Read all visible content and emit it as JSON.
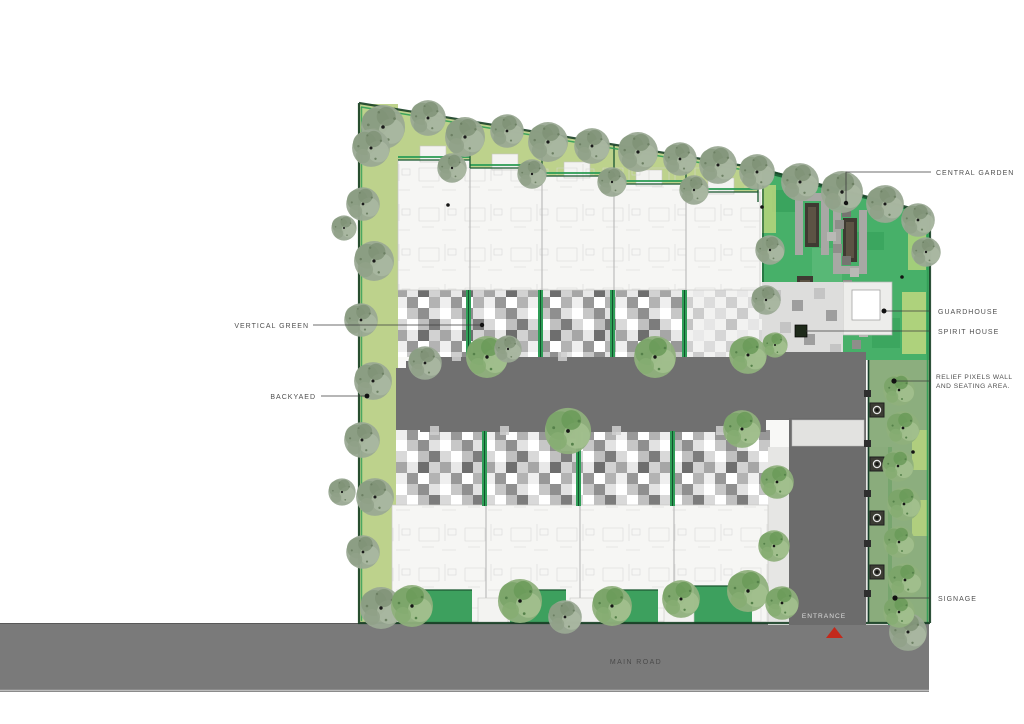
{
  "plan": {
    "annotations": {
      "central_garden": "CENTRAL GARDEN",
      "guardhouse": "GUARDHOUSE",
      "spirit_house": "SPIRIT HOUSE",
      "relief_wall_line1": "RELIEF PIXELS WALL",
      "relief_wall_line2": "AND SEATING AREA.",
      "signage": "SIGNAGE",
      "vertical_green": "VERTICAL GREEN",
      "backyard": "BACKYAED",
      "entrance": "ENTRANCE",
      "main_road": "MAIN ROAD"
    },
    "colors": {
      "road": "#7a7a7a",
      "driveway": "#6c6c6c",
      "courtyard_drive": "#707070",
      "garden_green": "#47b069",
      "lawn_green": "#bdd28c",
      "hedge_green": "#2f9e57",
      "boundary_green": "#173f25",
      "entrance_marker_red": "#c3291b",
      "annotation_text": "#4f4f4f"
    }
  }
}
